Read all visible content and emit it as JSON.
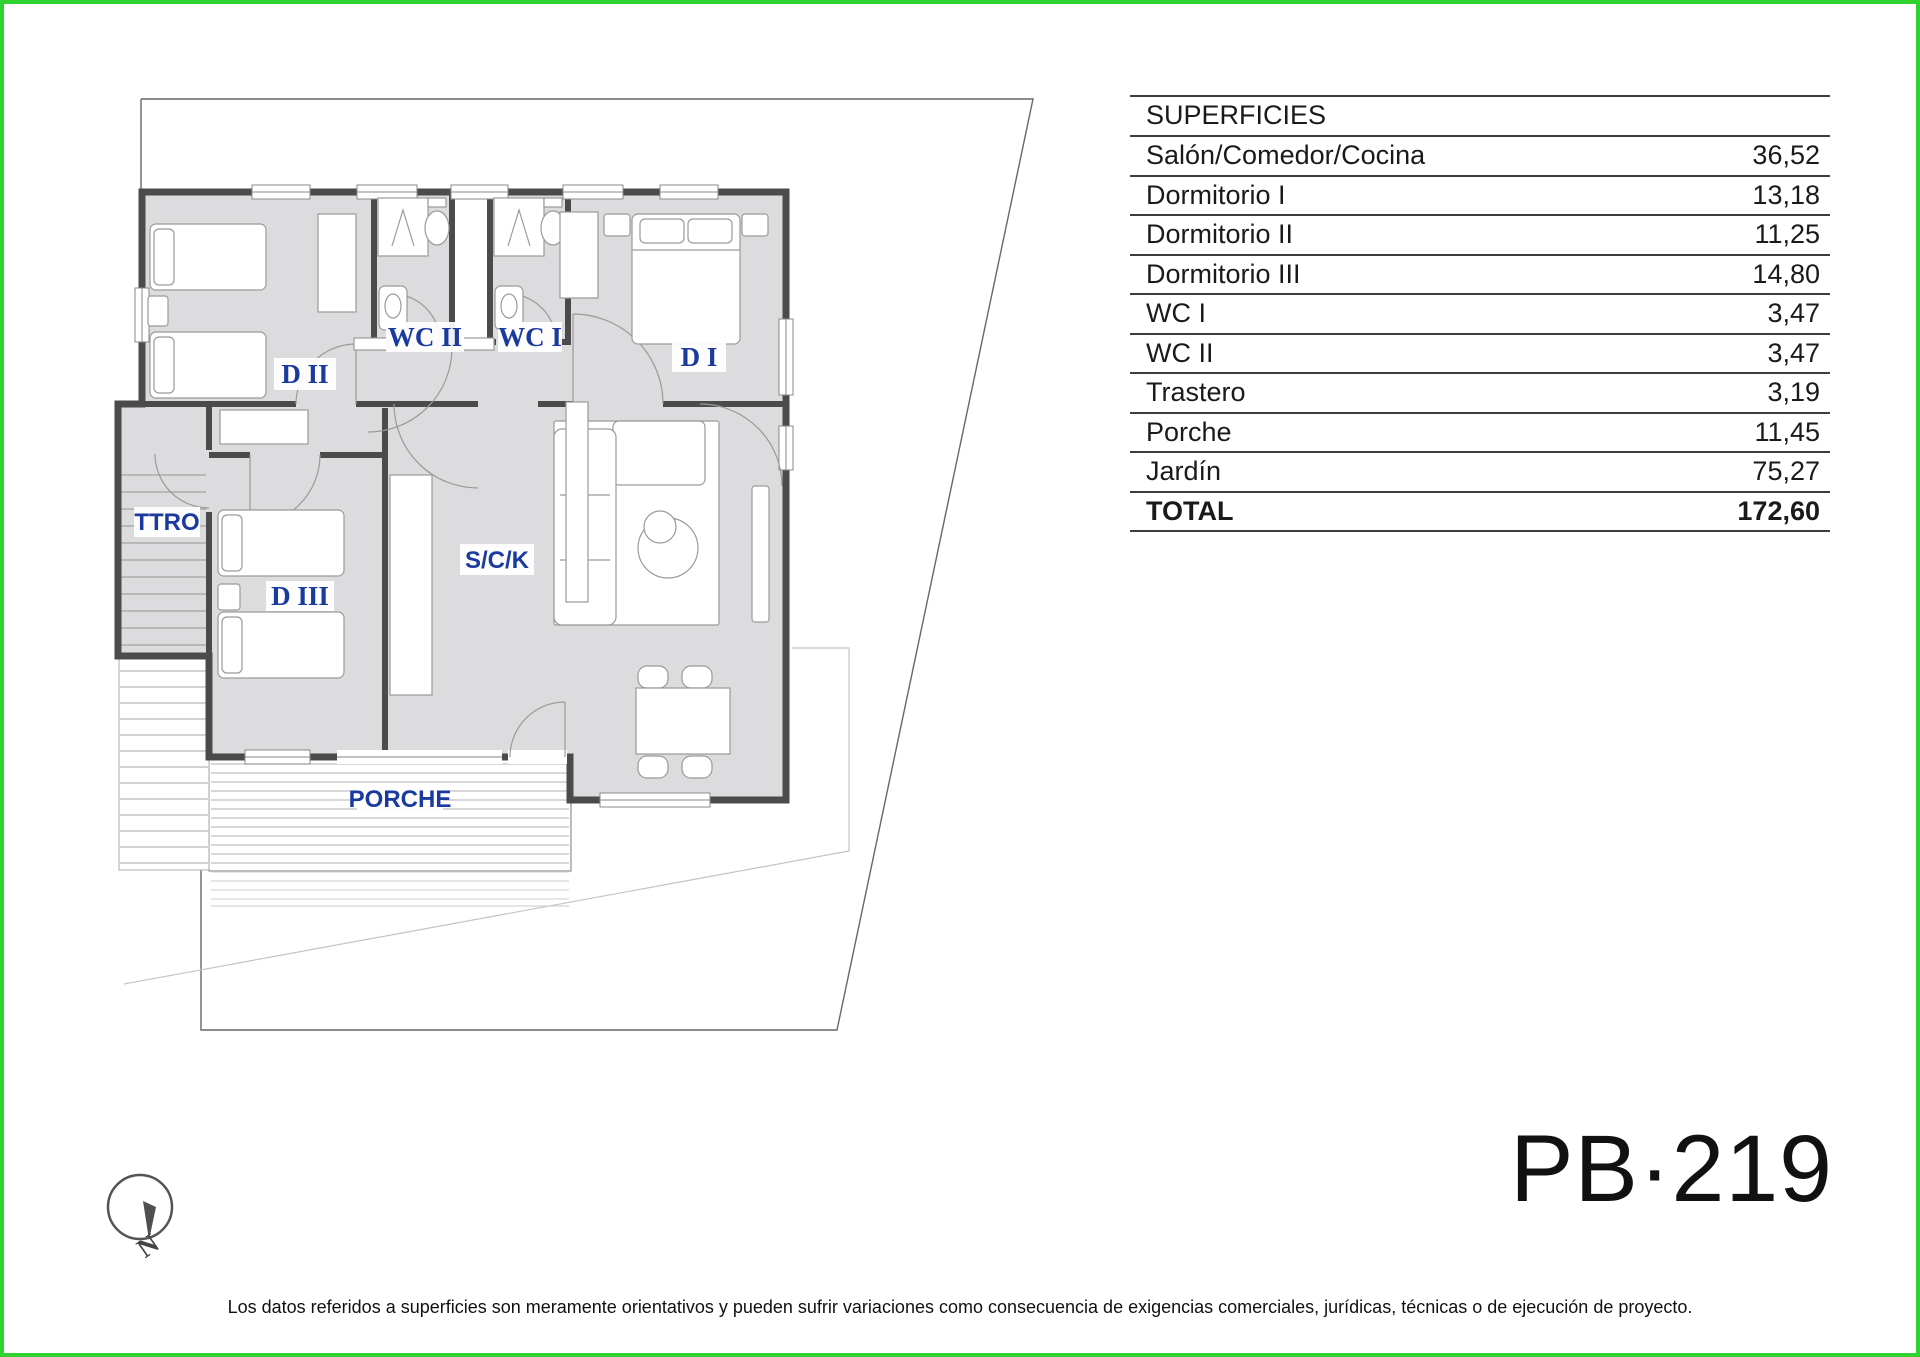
{
  "page": {
    "plan_code": "PB·219",
    "border_color": "#2fd32f",
    "disclaimer": "Los datos referidos a superficies son meramente orientativos y pueden sufrir variaciones como consecuencia de exigencias comerciales, jurídicas, técnicas o de ejecución de proyecto."
  },
  "surfaces": {
    "title": "SUPERFICIES",
    "rows": [
      {
        "label": "Salón/Comedor/Cocina",
        "value": "36,52"
      },
      {
        "label": "Dormitorio I",
        "value": "13,18"
      },
      {
        "label": "Dormitorio II",
        "value": "11,25"
      },
      {
        "label": "Dormitorio III",
        "value": "14,80"
      },
      {
        "label": "WC I",
        "value": "3,47"
      },
      {
        "label": "WC II",
        "value": "3,47"
      },
      {
        "label": "Trastero",
        "value": "3,19"
      },
      {
        "label": "Porche",
        "value": "11,45"
      },
      {
        "label": "Jardín",
        "value": "75,27"
      }
    ],
    "total_label": "TOTAL",
    "total_value": "172,60"
  },
  "plan": {
    "accent_color": "#1b3a9e",
    "wall_color": "#4b4b4b",
    "floor_fill": "#dcdcde",
    "labels": {
      "d2": "D II",
      "wc2": "WC II",
      "wc1": "WC I",
      "d1": "D I",
      "ttro": "TTRO",
      "d3": "D III",
      "sck": "S/C/K",
      "porche": "PORCHE"
    }
  },
  "compass": {
    "north_label": "N"
  }
}
